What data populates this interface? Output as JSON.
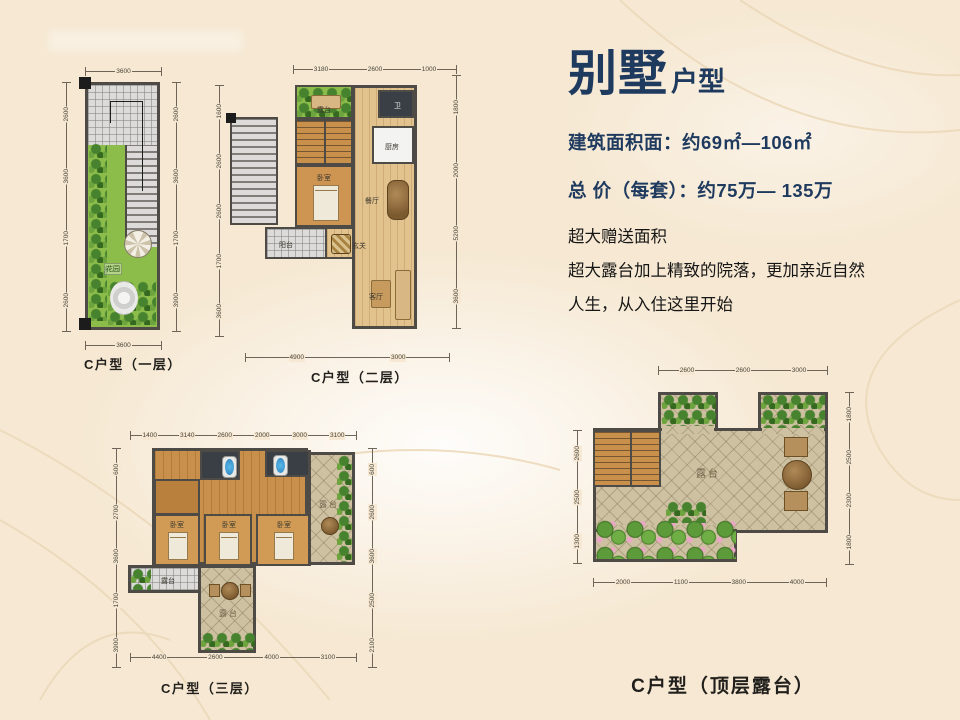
{
  "slide": {
    "bg": "#f6e8d2",
    "accent_navy": "#1e3a5e"
  },
  "header": {
    "title_main": "别墅",
    "title_suffix": "户型",
    "spec_area": "建筑面积面：约69㎡—106㎡",
    "spec_price": "总 价（每套）：约75万— 135万",
    "desc_lines": [
      "超大赠送面积",
      "超大露台加上精致的院落，更加亲近自然",
      "人生，从入住这里开始"
    ]
  },
  "plans": {
    "floor1": {
      "caption": "C户型（一层）",
      "labels": {
        "garden": "花园"
      },
      "dims": {
        "top": [
          "3600"
        ],
        "bottom": [
          "3600"
        ],
        "left": [
          "2600",
          "3600",
          "1700",
          "2600"
        ],
        "right": [
          "2600",
          "3600",
          "1700",
          "3900"
        ]
      }
    },
    "floor2": {
      "caption": "C户型（二层）",
      "labels": {
        "terrace": "露台",
        "wc": "卫",
        "kitchen": "厨房",
        "bedroom": "卧室",
        "dining": "餐厅",
        "foyer": "玄关",
        "balcony": "阳台",
        "living": "客厅"
      },
      "dims": {
        "top": [
          "3180",
          "2600",
          "1000"
        ],
        "bottom": [
          "4900",
          "3000"
        ],
        "left": [
          "1600",
          "2600",
          "2600",
          "1700",
          "3600"
        ],
        "right": [
          "1800",
          "2000",
          "5200",
          "3600"
        ]
      }
    },
    "floor3": {
      "caption": "C户型（三层）",
      "labels": {
        "bed1": "卧室",
        "bed2": "卧室",
        "bed3": "卧室",
        "terrace_left": "露台",
        "terrace_mid": "露台",
        "terrace_right": "露台"
      },
      "dims": {
        "top": [
          "1400",
          "3140",
          "2600",
          "2000",
          "3000",
          "3100"
        ],
        "bottom": [
          "4400",
          "2600",
          "4000",
          "3100"
        ],
        "left": [
          "600",
          "2700",
          "3600",
          "1700",
          "3900"
        ],
        "right": [
          "600",
          "2600",
          "3600",
          "2500",
          "2100"
        ]
      }
    },
    "roof": {
      "caption": "C户型（顶层露台）",
      "labels": {
        "terrace": "露台"
      },
      "dims": {
        "top": [
          "2600",
          "2600",
          "3000"
        ],
        "bottom": [
          "2000",
          "1100",
          "3800",
          "4000"
        ],
        "left": [
          "2600",
          "2500",
          "1300"
        ],
        "right": [
          "1800",
          "2500",
          "2300",
          "1800"
        ]
      }
    }
  }
}
